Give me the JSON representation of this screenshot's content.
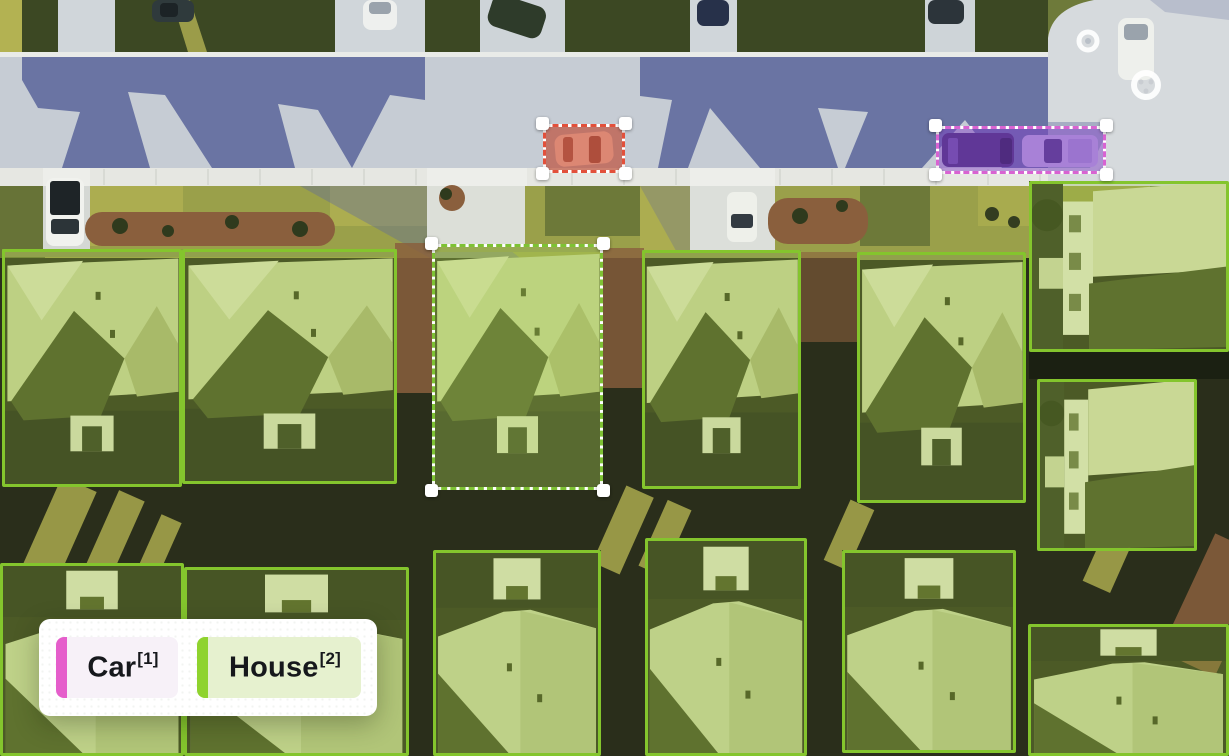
{
  "canvas": {
    "width": 1229,
    "height": 756,
    "description": "aerial neighborhood photo with object-detection annotations"
  },
  "legend": {
    "items": [
      {
        "label": "Car",
        "shortcut": "[1]",
        "bar_color": "#e55ecb",
        "bg_color": "#f7f1f8",
        "text_color": "#16181c"
      },
      {
        "label": "House",
        "shortcut": "[2]",
        "bar_color": "#8fd32e",
        "bg_color": "#e6f1cf",
        "text_color": "#16181c"
      }
    ]
  },
  "annotations": {
    "classes": {
      "car": {
        "border_color": "#e2503b",
        "fill": "rgba(205,75,52,0.45)"
      },
      "house": {
        "border_color": "#84c52d",
        "fill": "rgba(164,206,70,0.28)"
      }
    },
    "boxes": [
      {
        "id": "car-1",
        "class": "Car",
        "style": "dashed",
        "handles": true,
        "x": 543,
        "y": 124,
        "w": 82,
        "h": 49,
        "border_color": "#e2503b",
        "fill": "rgba(205,70,45,0.45)",
        "variant": "sedan"
      },
      {
        "id": "car-2",
        "class": "Car",
        "style": "dashed",
        "handles": true,
        "x": 936,
        "y": 126,
        "w": 170,
        "h": 48,
        "border_color": "#d863d2",
        "fill": "rgba(128,62,198,0.48)",
        "variant": "two-vehicles"
      },
      {
        "id": "house-sel",
        "class": "House",
        "style": "dashed",
        "handles": true,
        "x": 432,
        "y": 244,
        "w": 171,
        "h": 246,
        "border_color": "#7ec234",
        "fill": "rgba(172,212,82,0.40)",
        "variant": "front"
      },
      {
        "id": "house-1",
        "class": "House",
        "style": "solid",
        "handles": false,
        "x": 2,
        "y": 249,
        "w": 180,
        "h": 238,
        "variant": "front"
      },
      {
        "id": "house-2",
        "class": "House",
        "style": "solid",
        "handles": false,
        "x": 182,
        "y": 249,
        "w": 215,
        "h": 235,
        "variant": "front"
      },
      {
        "id": "house-3",
        "class": "House",
        "style": "solid",
        "handles": false,
        "x": 642,
        "y": 250,
        "w": 159,
        "h": 239,
        "variant": "front"
      },
      {
        "id": "house-4",
        "class": "House",
        "style": "solid",
        "handles": false,
        "x": 857,
        "y": 252,
        "w": 169,
        "h": 251,
        "variant": "front"
      },
      {
        "id": "house-5",
        "class": "House",
        "style": "solid",
        "handles": false,
        "x": 1029,
        "y": 181,
        "w": 200,
        "h": 171,
        "variant": "side"
      },
      {
        "id": "house-6",
        "class": "House",
        "style": "solid",
        "handles": false,
        "x": 1037,
        "y": 379,
        "w": 160,
        "h": 172,
        "variant": "side"
      },
      {
        "id": "house-7",
        "class": "House",
        "style": "solid",
        "handles": false,
        "x": 0,
        "y": 563,
        "w": 184,
        "h": 193,
        "variant": "back"
      },
      {
        "id": "house-8",
        "class": "House",
        "style": "solid",
        "handles": false,
        "x": 184,
        "y": 567,
        "w": 225,
        "h": 189,
        "variant": "back"
      },
      {
        "id": "house-9",
        "class": "House",
        "style": "solid",
        "handles": false,
        "x": 433,
        "y": 550,
        "w": 168,
        "h": 206,
        "variant": "back"
      },
      {
        "id": "house-10",
        "class": "House",
        "style": "solid",
        "handles": false,
        "x": 645,
        "y": 538,
        "w": 162,
        "h": 218,
        "variant": "back"
      },
      {
        "id": "house-11",
        "class": "House",
        "style": "solid",
        "handles": false,
        "x": 842,
        "y": 550,
        "w": 174,
        "h": 203,
        "variant": "back"
      },
      {
        "id": "house-12",
        "class": "House",
        "style": "solid",
        "handles": false,
        "x": 1028,
        "y": 624,
        "w": 201,
        "h": 132,
        "variant": "back"
      }
    ]
  },
  "scene": {
    "palette": {
      "road": "#c6ccd4",
      "shadow": "#5f6a9d",
      "sidewalk": "#e6e7e2",
      "apron": "#d6dadd",
      "lawn": "#9aa04a",
      "grass_lit": "#b3b252",
      "grass_dark": "#3c4823",
      "mulch": "#8a5f3d",
      "ground_dark": "#2a2e1b"
    }
  }
}
